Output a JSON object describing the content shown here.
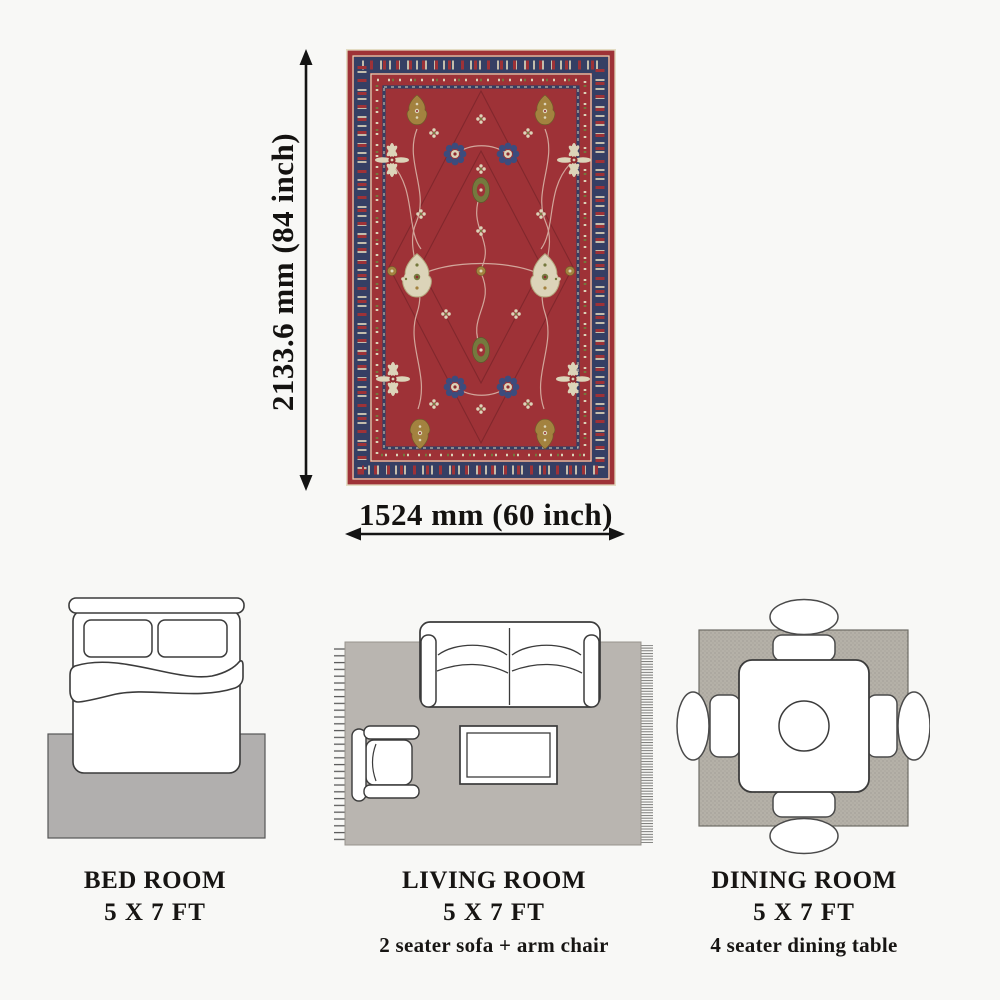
{
  "page": {
    "background": "#f8f8f6",
    "text_color": "#171513"
  },
  "dimensions": {
    "height_label": "2133.6 mm (84 inch)",
    "width_label": "1524 mm (60 inch)",
    "arrow_color": "#141414"
  },
  "rug_colors": {
    "field_red": "#9e3237",
    "border_navy": "#353f64",
    "cream": "#dcd4b9",
    "olive": "#75793e",
    "gold": "#a3823f",
    "vine": "#d8b3a6",
    "edge": "#e3dcc3"
  },
  "room_plan_colors": {
    "bedroom_rug": "#b1afae",
    "living_rug": "#b9b5b0",
    "dining_rug": "#b5b1a8",
    "furniture_fill": "#ffffff",
    "furniture_stroke": "#3b3b3b"
  },
  "rooms": [
    {
      "title": "BED ROOM",
      "size": "5 X 7 FT",
      "note": ""
    },
    {
      "title": "LIVING ROOM",
      "size": "5 X 7 FT",
      "note": "2 seater sofa + arm chair"
    },
    {
      "title": "DINING ROOM",
      "size": "5 X 7 FT",
      "note": "4 seater dining table"
    }
  ]
}
